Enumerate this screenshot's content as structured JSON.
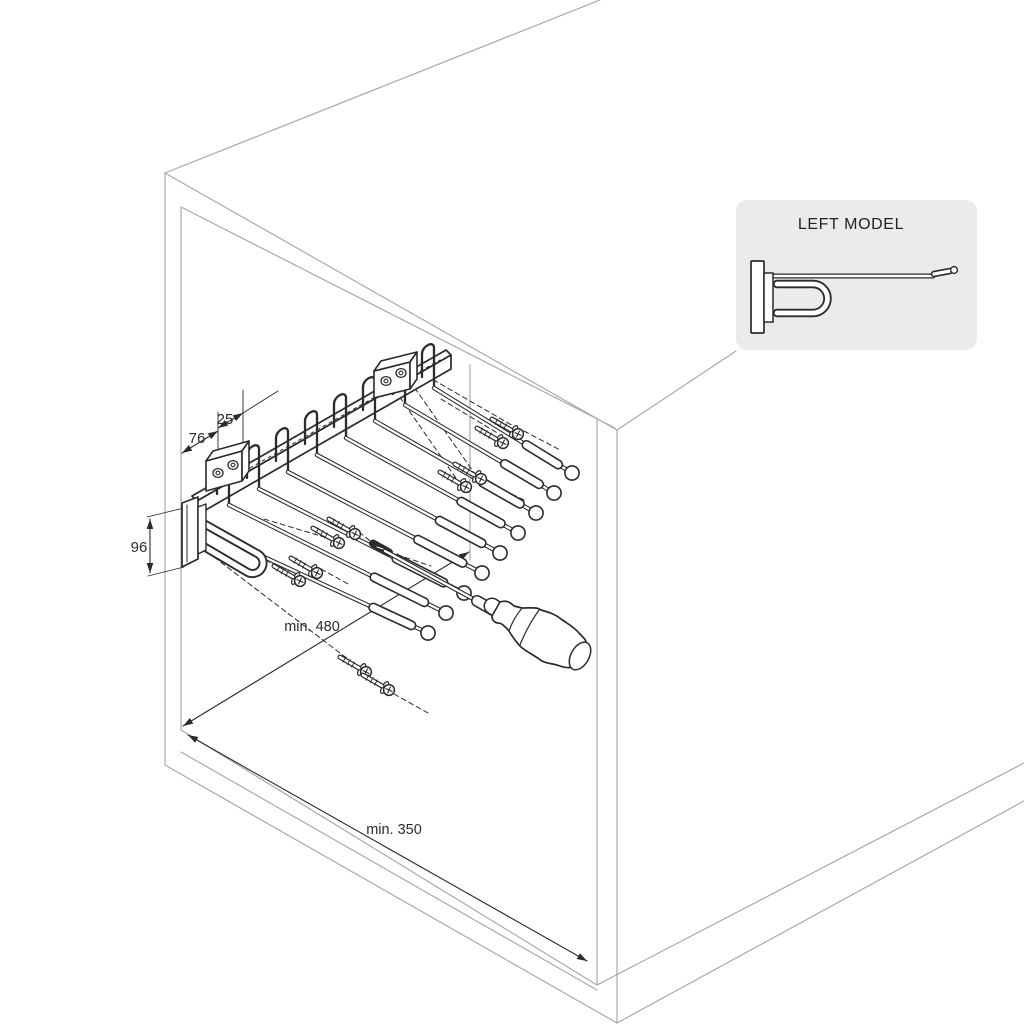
{
  "inset": {
    "title": "LEFT MODEL"
  },
  "dimensions": {
    "bracket_offset": "76",
    "hole_spacing": "25",
    "rail_height": "96",
    "min_depth": "min. 480",
    "min_width": "min. 350"
  },
  "colors": {
    "background": "#ffffff",
    "cabinet_line": "#a9a9a9",
    "drawing_line": "#2b2b2b",
    "panel_fill": "#ebebeb",
    "text": "#222222"
  },
  "drawing": {
    "cabinet_lines": [
      [
        165,
        173,
        165,
        765
      ],
      [
        181,
        207,
        181,
        730
      ],
      [
        165,
        173,
        600,
        0
      ],
      [
        165,
        173,
        617,
        430
      ],
      [
        181,
        207,
        615,
        428
      ],
      [
        617,
        430,
        617,
        1023
      ],
      [
        597,
        418,
        597,
        985
      ],
      [
        165,
        765,
        617,
        1023
      ],
      [
        181,
        730,
        597,
        985
      ],
      [
        181,
        752,
        597,
        990
      ],
      [
        597,
        985,
        1024,
        763
      ],
      [
        617,
        1023,
        1024,
        801
      ],
      [
        617,
        430,
        736,
        351
      ],
      [
        470,
        365,
        470,
        560
      ]
    ],
    "ext_lines": [
      [
        218,
        412,
        218,
        468
      ],
      [
        243,
        390,
        243,
        452
      ],
      [
        147,
        517,
        184,
        508
      ],
      [
        148,
        576,
        184,
        567
      ],
      [
        243,
        413,
        278,
        391
      ]
    ],
    "dim_lines": {
      "d76": [
        182,
        453,
        218,
        431
      ],
      "d25": [
        218,
        428,
        243,
        413
      ],
      "d96": [
        150,
        519,
        150,
        573
      ],
      "d480": [
        183,
        726,
        469,
        552
      ],
      "d350": [
        188,
        735,
        587,
        961
      ]
    },
    "rail": {
      "top": [
        [
          192,
          496
        ],
        [
          446,
          350
        ],
        [
          451,
          355
        ],
        [
          197,
          501
        ]
      ],
      "front": [
        [
          197,
          501
        ],
        [
          451,
          355
        ],
        [
          451,
          369
        ],
        [
          197,
          515
        ]
      ],
      "track_dash": [
        250,
        468,
        440,
        360
      ]
    },
    "plate": {
      "outer": [
        [
          182,
          503
        ],
        [
          198,
          497
        ],
        [
          198,
          559
        ],
        [
          182,
          567
        ]
      ],
      "inner": [
        187,
        505,
        187,
        562
      ]
    },
    "flange": [
      [
        198,
        507
      ],
      [
        206,
        504
      ],
      [
        206,
        550
      ],
      [
        198,
        554
      ]
    ],
    "hooks": [
      [
        217,
        481
      ],
      [
        247,
        465
      ],
      [
        276,
        448
      ],
      [
        305,
        431
      ],
      [
        334,
        414
      ],
      [
        363,
        397
      ],
      [
        393,
        381
      ],
      [
        422,
        364
      ]
    ],
    "u_handle": "M201,522 L258,554 A10.5,10.5 0 1 1 247,572 L191,539",
    "rods": [
      [
        262,
        556,
        428,
        633
      ],
      [
        229,
        505,
        446,
        613
      ],
      [
        259,
        489,
        464,
        593
      ],
      [
        288,
        472,
        482,
        573
      ],
      [
        317,
        455,
        500,
        553
      ],
      [
        346,
        438,
        518,
        533
      ],
      [
        375,
        421,
        536,
        513
      ],
      [
        405,
        405,
        554,
        493
      ],
      [
        434,
        388,
        572,
        473
      ]
    ],
    "brackets": [
      {
        "front": [
          [
            374,
            371
          ],
          [
            410,
            362
          ],
          [
            410,
            389
          ],
          [
            374,
            398
          ]
        ],
        "top": [
          [
            374,
            371
          ],
          [
            381,
            361
          ],
          [
            417,
            352
          ],
          [
            410,
            362
          ]
        ],
        "side": [
          [
            410,
            362
          ],
          [
            417,
            352
          ],
          [
            417,
            379
          ],
          [
            410,
            389
          ]
        ],
        "holes": [
          [
            386,
            381
          ],
          [
            401,
            373
          ]
        ]
      },
      {
        "front": [
          [
            206,
            461
          ],
          [
            242,
            451
          ],
          [
            242,
            481
          ],
          [
            206,
            491
          ]
        ],
        "top": [
          [
            206,
            461
          ],
          [
            213,
            451
          ],
          [
            249,
            441
          ],
          [
            242,
            451
          ]
        ],
        "side": [
          [
            242,
            451
          ],
          [
            249,
            441
          ],
          [
            249,
            471
          ],
          [
            242,
            481
          ]
        ],
        "holes": [
          [
            218,
            473
          ],
          [
            233,
            465
          ]
        ]
      }
    ],
    "screws": [
      [
        300,
        581
      ],
      [
        317,
        573
      ],
      [
        339,
        543
      ],
      [
        355,
        534
      ],
      [
        366,
        672
      ],
      [
        389,
        690
      ],
      [
        466,
        487
      ],
      [
        481,
        479
      ],
      [
        503,
        443
      ],
      [
        518,
        434
      ]
    ],
    "dark_screw": [
      381,
      548
    ],
    "leaders": [
      [
        214,
        557,
        357,
        666
      ],
      [
        394,
        694,
        428,
        713
      ],
      [
        236,
        543,
        294,
        576
      ],
      [
        321,
        569,
        350,
        585
      ],
      [
        264,
        519,
        334,
        540
      ],
      [
        359,
        532,
        374,
        544
      ],
      [
        389,
        552,
        431,
        566
      ],
      [
        390,
        383,
        460,
        484
      ],
      [
        405,
        374,
        477,
        477
      ],
      [
        489,
        483,
        524,
        500
      ],
      [
        441,
        399,
        499,
        434
      ],
      [
        411,
        367,
        515,
        427
      ],
      [
        524,
        431,
        560,
        450
      ]
    ],
    "screwdriver": {
      "shaft": [
        385,
        551,
        477,
        601
      ],
      "ferrule": [
        477,
        601,
        493,
        610
      ],
      "collar": [
        492,
        606,
        501,
        612
      ],
      "handle_path": "M500,602 C506,600 510,602 514,606 L522,608 C532,608 537,607 541,610 C548,612 555,614 561,619 C568,624 574,627 579,633 C584,638 587,641 587,646 C589,651 589,655 587,659 C585,664 581,667 576,667 C570,668 565,668 560,666 C552,663 545,664 539,659 C532,654 527,652 521,647 C516,642 512,636 509,631 C506,627 505,627 503,625 C500,622 497,624 495,622 C492,620 492,618 492,616 Z",
      "cap": {
        "cx": 580,
        "cy": 656,
        "rx": 9,
        "ry": 15,
        "rot": 29
      },
      "contours": [
        "M522,608 Q513,619 509,631",
        "M539,610 Q527,627 520,645"
      ]
    },
    "inset_panel": {
      "rect": [
        736,
        200,
        241,
        150
      ],
      "plate": [
        751,
        261,
        13,
        72
      ],
      "flange": [
        764,
        273,
        9,
        49
      ],
      "u_spine": "M777,284 L813,284 A14.5,14.5 0 0 1 813,313 L777,313",
      "rod": [
        775,
        276,
        933,
        276
      ],
      "tip": [
        934,
        274,
        950,
        271
      ],
      "tip_ball": [
        954,
        270,
        3.4
      ]
    }
  }
}
